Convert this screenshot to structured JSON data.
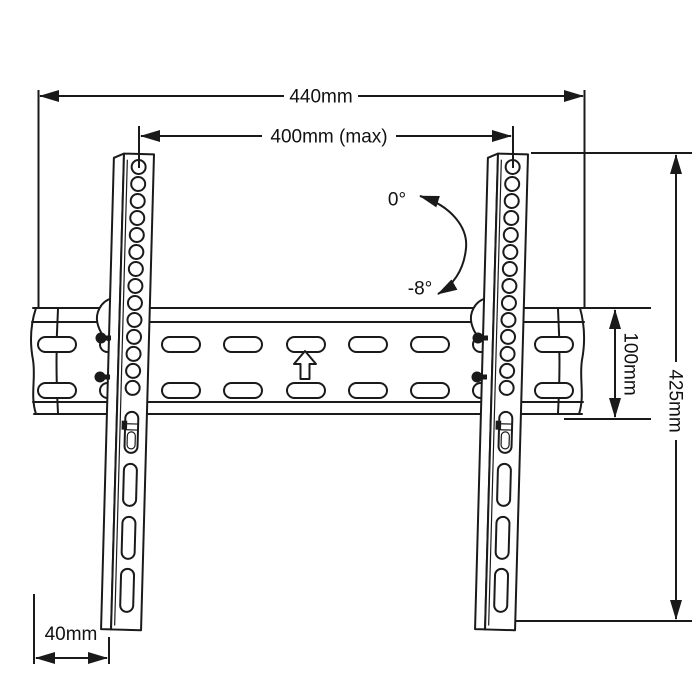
{
  "page": {
    "background": "#ffffff",
    "ink": "#1a1a1a"
  },
  "diagram": {
    "subject": "Tilting TV wall-mount bracket - dimensioned technical drawing",
    "dimensions": {
      "overall_width": "440mm",
      "mount_hole_width": "400mm (max)",
      "overall_height": "425mm",
      "wall_plate_height": "100mm",
      "bottom_side_offset": "40mm"
    },
    "tilt": {
      "upper": "0°",
      "lower": "-8°"
    },
    "icons": {
      "orientation_arrow": "up-arrow"
    }
  }
}
